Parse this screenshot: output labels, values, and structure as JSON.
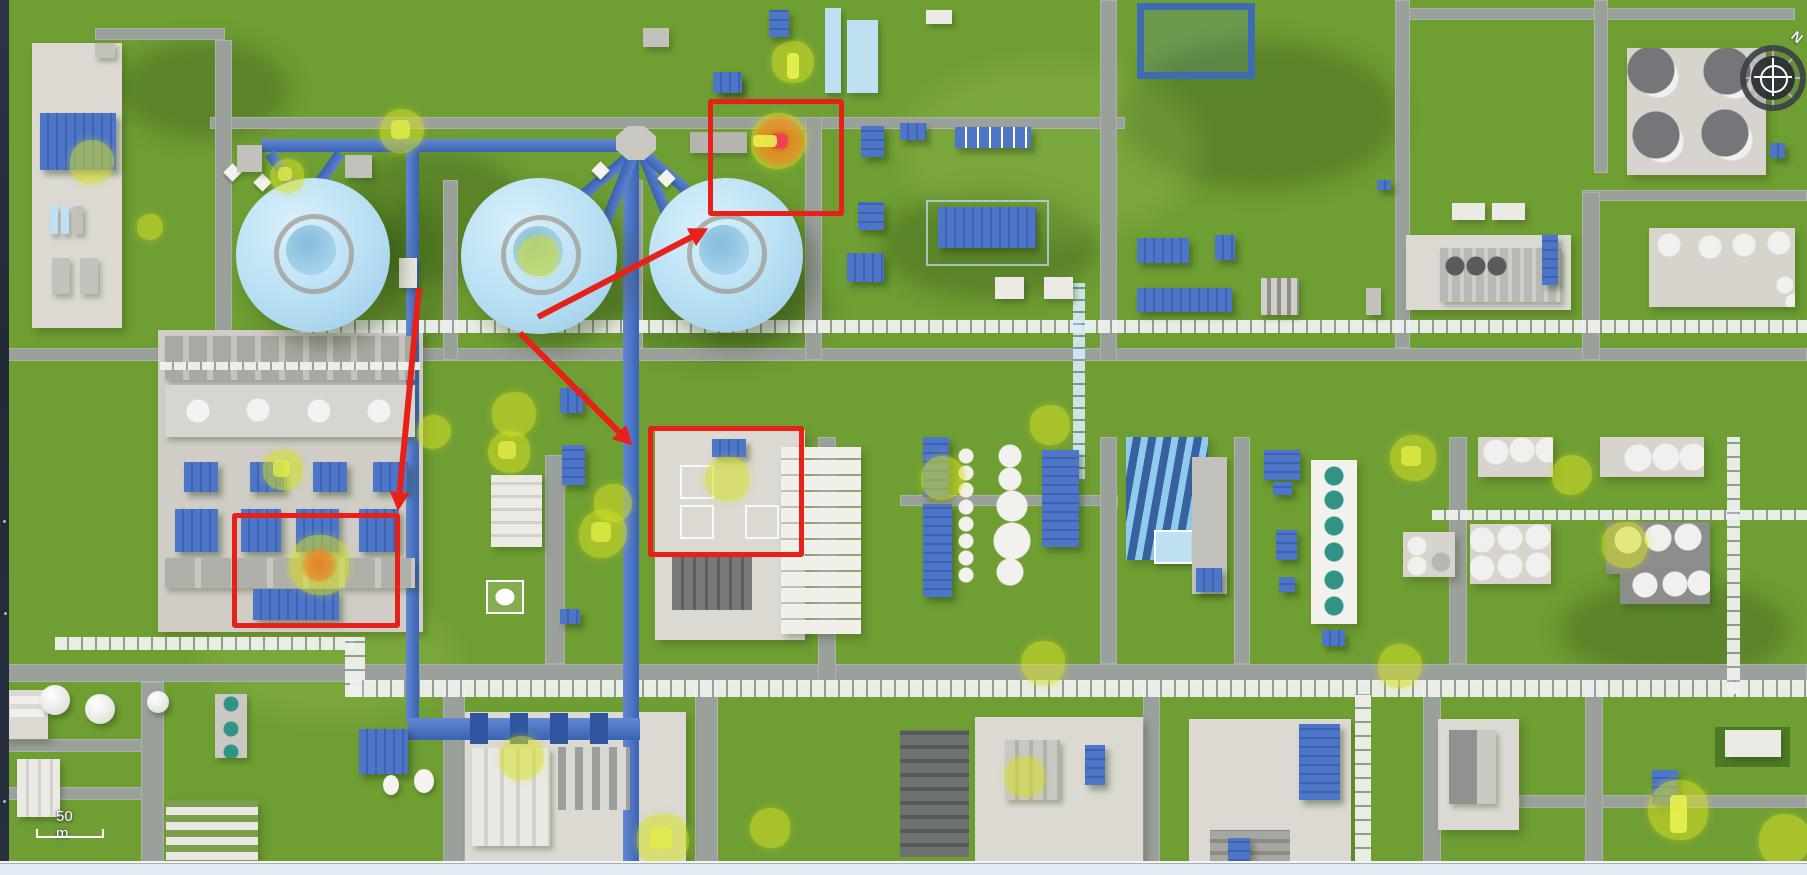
{
  "scene": {
    "type": "3d-industrial-plant-map",
    "compass": {
      "north_label": "N"
    },
    "scale_bar": {
      "label": "50 m"
    },
    "colors": {
      "grass_green": "#6f9e33",
      "road_gray": "#9aa09a",
      "building_blue": "#4e76c8",
      "sphere_blue": "#b7dff3",
      "marker_yellow": "#d5e022",
      "hotspot_orange": "#e8882e",
      "hotspot_red": "#ef4056",
      "annotation_red": "#e8201a"
    },
    "annotations": {
      "boxes": [
        {
          "x": 708,
          "y": 99,
          "w": 136,
          "h": 117
        },
        {
          "x": 648,
          "y": 426,
          "w": 156,
          "h": 131
        },
        {
          "x": 232,
          "y": 513,
          "w": 168,
          "h": 115
        }
      ],
      "arrows": [
        {
          "x1": 538,
          "y1": 317,
          "x2": 707,
          "y2": 229
        },
        {
          "x1": 520,
          "y1": 333,
          "x2": 632,
          "y2": 445
        },
        {
          "x1": 419,
          "y1": 288,
          "x2": 398,
          "y2": 510
        }
      ]
    },
    "markers": [
      {
        "x": 92,
        "y": 162,
        "r": 22
      },
      {
        "x": 150,
        "y": 227,
        "r": 13
      },
      {
        "x": 287,
        "y": 176,
        "r": 17,
        "inner": "square"
      },
      {
        "x": 402,
        "y": 131,
        "r": 22,
        "inner": "square"
      },
      {
        "x": 793,
        "y": 62,
        "r": 21,
        "inner": "bar-v"
      },
      {
        "x": 538,
        "y": 256,
        "r": 20
      },
      {
        "x": 779,
        "y": 141,
        "r": 28,
        "type": "hotspot",
        "orange_r": 17,
        "red_core": true,
        "bar": true
      },
      {
        "x": 514,
        "y": 414,
        "r": 22
      },
      {
        "x": 509,
        "y": 452,
        "r": 21,
        "inner": "square"
      },
      {
        "x": 434,
        "y": 432,
        "r": 17
      },
      {
        "x": 283,
        "y": 470,
        "r": 20,
        "inner": "square"
      },
      {
        "x": 319,
        "y": 565,
        "r": 30,
        "type": "hotspot",
        "orange_r": 11,
        "red_core": false,
        "bar": false
      },
      {
        "x": 603,
        "y": 534,
        "r": 24,
        "inner": "square"
      },
      {
        "x": 613,
        "y": 503,
        "r": 19
      },
      {
        "x": 727,
        "y": 479,
        "r": 22
      },
      {
        "x": 522,
        "y": 758,
        "r": 22
      },
      {
        "x": 663,
        "y": 840,
        "r": 26,
        "inner": "square"
      },
      {
        "x": 770,
        "y": 828,
        "r": 20
      },
      {
        "x": 943,
        "y": 478,
        "r": 22
      },
      {
        "x": 1050,
        "y": 425,
        "r": 20
      },
      {
        "x": 1413,
        "y": 458,
        "r": 23,
        "inner": "square"
      },
      {
        "x": 1572,
        "y": 475,
        "r": 20
      },
      {
        "x": 1625,
        "y": 545,
        "r": 23
      },
      {
        "x": 1043,
        "y": 663,
        "r": 22
      },
      {
        "x": 1400,
        "y": 666,
        "r": 22
      },
      {
        "x": 1025,
        "y": 777,
        "r": 20
      },
      {
        "x": 1678,
        "y": 810,
        "r": 30,
        "inner": "bar-v"
      },
      {
        "x": 1785,
        "y": 840,
        "r": 26
      }
    ]
  }
}
